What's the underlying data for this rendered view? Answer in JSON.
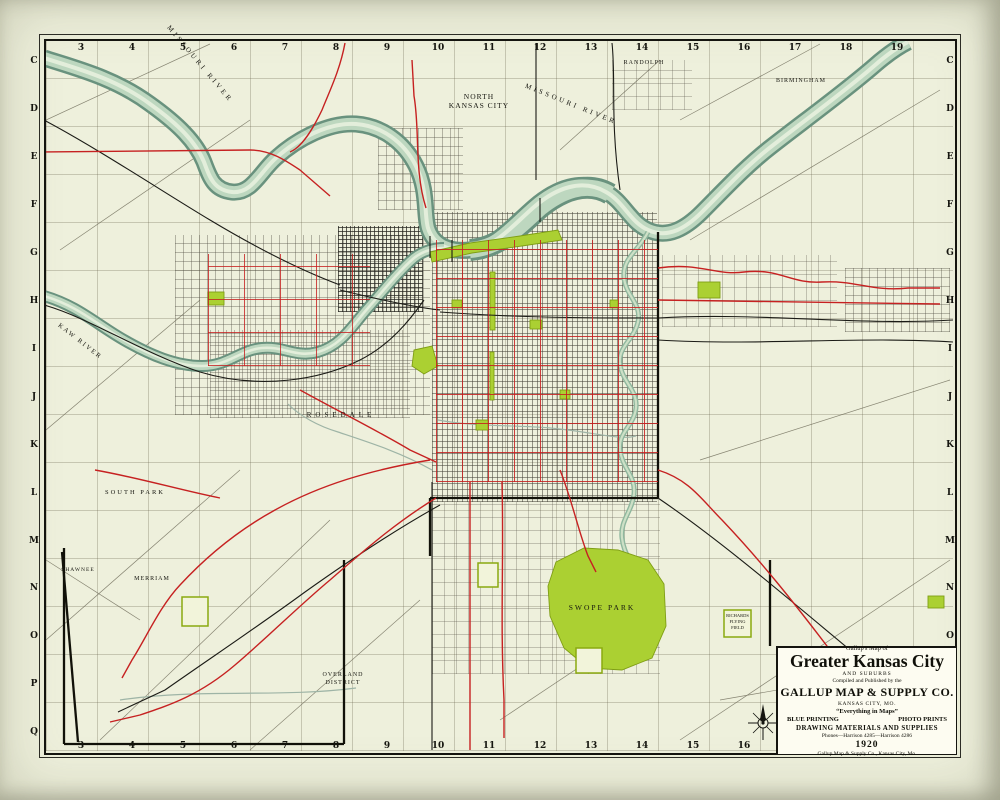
{
  "map": {
    "grid": {
      "columns": [
        "3",
        "4",
        "5",
        "6",
        "7",
        "8",
        "9",
        "10",
        "11",
        "12",
        "13",
        "14",
        "15",
        "16",
        "17",
        "18",
        "19"
      ],
      "rows": [
        "C",
        "D",
        "E",
        "F",
        "G",
        "H",
        "I",
        "J",
        "K",
        "L",
        "M",
        "N",
        "O",
        "P",
        "Q"
      ]
    },
    "labels": {
      "missouri_river_nw": "MISSOURI RIVER",
      "missouri_river_east": "MISSOURI RIVER",
      "kaw_river": "KAW RIVER",
      "north_kansas_city": "NORTH KANSAS CITY",
      "randolph": "RANDOLPH",
      "birmingham": "BIRMINGHAM",
      "rosedale": "ROSEDALE",
      "merriam": "MERRIAM",
      "shawnee": "SHAWNEE",
      "south_park": "SOUTH PARK",
      "overland_district": "OVERLAND DISTRICT",
      "swope_park": "SWOPE PARK",
      "richards_flying_field": "RICHARDS FLYING FIELD"
    },
    "title_block": {
      "kicker": "Gallup's Map of",
      "title": "Greater Kansas City",
      "subtitle": "AND SUBURBS",
      "published_by": "Compiled and Published by the",
      "company": "GALLUP MAP & SUPPLY CO.",
      "city": "KANSAS CITY, MO.",
      "slogan": "“Everything in Maps”",
      "service_left": "BLUE PRINTING",
      "service_right": "PHOTO PRINTS",
      "service_center": "DRAWING MATERIALS AND SUPPLIES",
      "phones": "Phones—Harrison 4285—Harrison 4286",
      "year": "1920",
      "imprint": "Gallup Map & Supply Co., Kansas City, Mo."
    },
    "colors": {
      "paper": "#fbf8e8",
      "margin": "#eef0dc",
      "river_edge": "#69927e",
      "river_fill": "#bdd7bf",
      "park": "#abd032",
      "streetcar": "#c62121",
      "railroad": "#1b1b16"
    }
  }
}
